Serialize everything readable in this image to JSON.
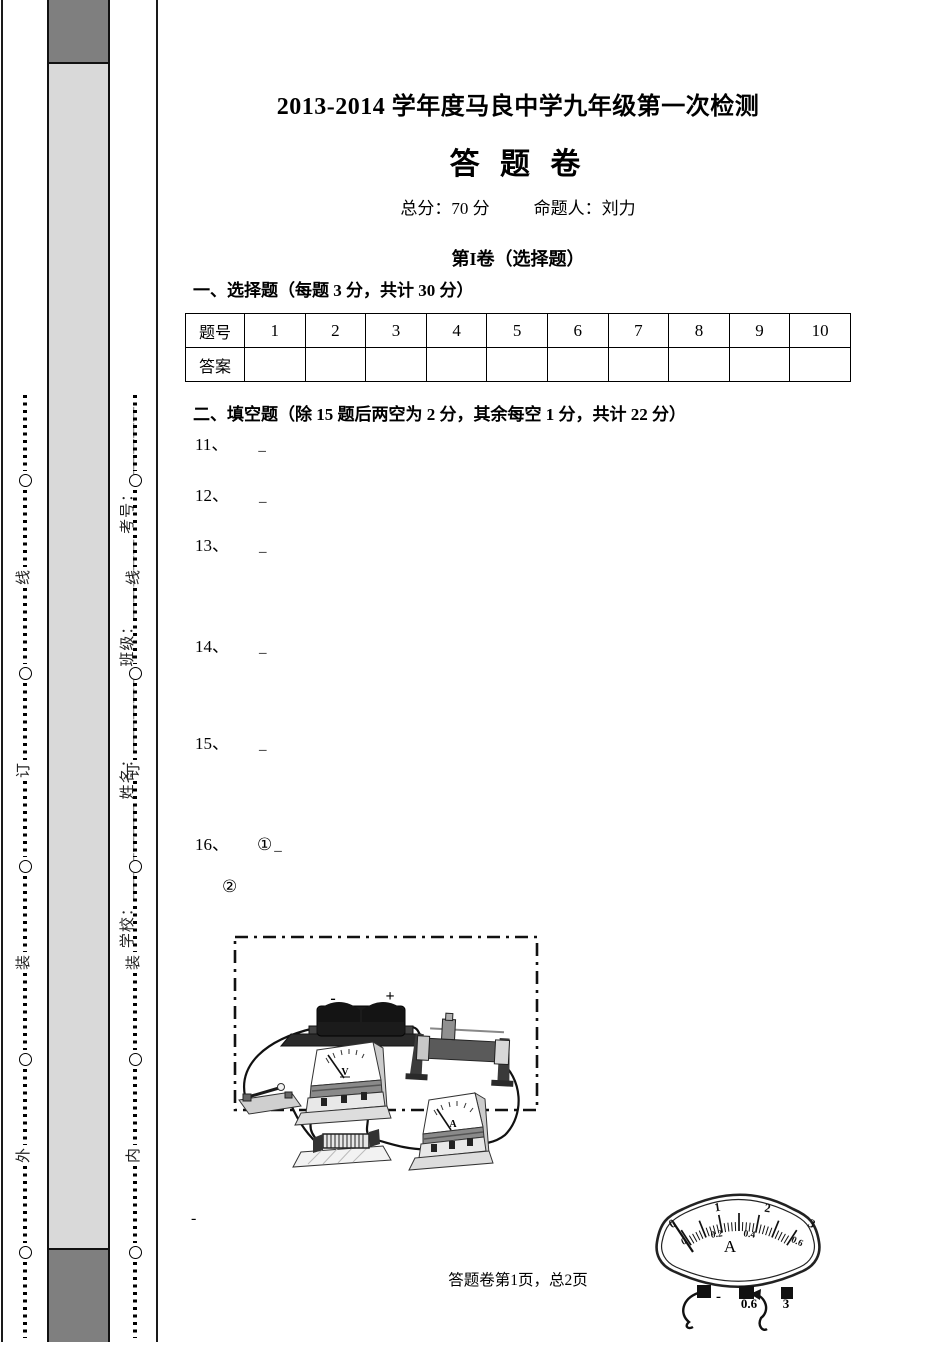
{
  "header": {
    "title": "2013-2014 学年度马良中学九年级第一次检测",
    "sheet_name": "答 题 卷",
    "total_score": "总分：70 分",
    "setter": "命题人：刘力"
  },
  "sections": {
    "part1_header": "第I卷（选择题）",
    "choice_heading": "一、选择题（每题 3 分，共计 30 分）",
    "fill_heading": "二、填空题（除 15 题后两空为 2 分，其余每空 1 分，共计 22 分）"
  },
  "answer_table": {
    "header_label": "题号",
    "answer_label": "答案",
    "numbers": [
      "1",
      "2",
      "3",
      "4",
      "5",
      "6",
      "7",
      "8",
      "9",
      "10"
    ]
  },
  "fill_blank": "_",
  "questions": [
    "11、",
    "12、",
    "13、",
    "14、",
    "15、"
  ],
  "q16": {
    "label": "16、",
    "sub1": "①",
    "sub2": "②"
  },
  "binding": {
    "outer_chars": [
      "线",
      "订",
      "装",
      "外"
    ],
    "inner_chars": [
      "线",
      "订",
      "装",
      "内"
    ],
    "student_fields": "学校：＿＿＿＿＿＿ 姓名：＿＿＿＿＿ 班级：＿＿＿＿＿ 考号：＿＿＿＿＿"
  },
  "figure_circuit": {
    "battery_minus": "-",
    "battery_plus": "+",
    "voltmeter_label": "V",
    "ammeter_label": "A"
  },
  "figure_ammeter": {
    "outer_scale": [
      "0",
      "1",
      "2",
      "3"
    ],
    "inner_scale": [
      "0",
      "0.2",
      "0.4",
      "0.6"
    ],
    "unit": "A",
    "terminal_minus": "-",
    "terminal_mid": "0.6",
    "terminal_right": "3"
  },
  "footer": {
    "page_info": "答题卷第1页，总2页",
    "stray_mark": "-"
  },
  "colors": {
    "strip_light": "#d9d9d9",
    "strip_dark": "#7f7f7f"
  }
}
